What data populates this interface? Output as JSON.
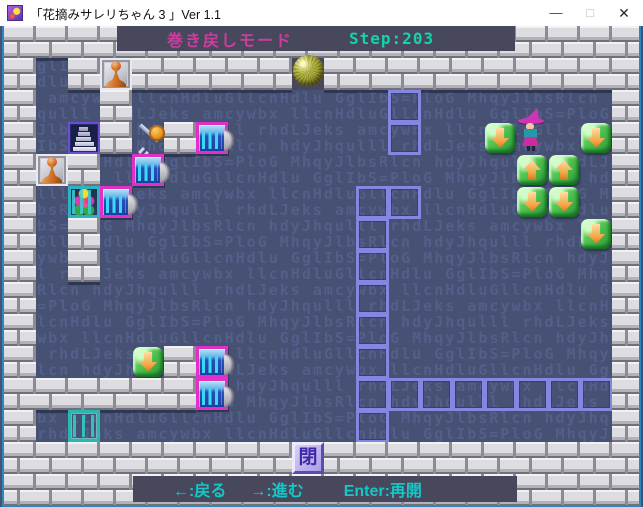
{
  "window": {
    "title": "「花摘みサレリちゃん 3 」Ver 1.1",
    "minimize_label": "—",
    "maximize_label": "□",
    "close_label": "✕"
  },
  "hud": {
    "mode": "巻き戻しモード",
    "step": "Step:203"
  },
  "controls": {
    "back": "←:戻る",
    "forward": "→:進む",
    "resume": "Enter:再開"
  },
  "board": {
    "tile_size": 32,
    "cols": 20,
    "rows": 15,
    "close_label": "閉",
    "legend": {
      "#": "brick-wall",
      ".": "empty-floor",
      "P": "pawn-block",
      "S": "stairs",
      "K": "key",
      "G": "closed-gate",
      "O": "open-gate",
      "F": "flower-cage",
      "D": "arrow-tile-down",
      "U": "arrow-tile-up",
      "B": "ball",
      "W": "witch-player",
      "T": "trail-marker",
      "C": "close-tile"
    },
    "map": [
      "####################",
      "#.#P#####B##########",
      "#..#........T......#",
      "#.S#K#G.....T..DW.D#",
      "#P#.G...........UU.#",
      "#.FG.......TT...DD.#",
      "#.#........T......D#",
      "#.#........T.......#",
      "#..........T.......#",
      "#..........T.......#",
      "#...D#G....T.......#",
      "######G....TTTTTTTT#",
      "#.O........T.......#",
      "#########C##########",
      "####################"
    ]
  },
  "watermark": {
    "text": "hdyJhqulll rhdLJeks amcywbx llcnHdluGllcnHdlu GglIbS=PloG MhqyJlbsRlcn "
  },
  "colors": {
    "field_bg": "#465174",
    "brick": "#dcdce1",
    "mortar": "#8b8b95",
    "hud_bg": "#47485c",
    "mode_text": "#cf3ba0",
    "step_text": "#17d1ae",
    "controls_text": "#14c8c8",
    "trail": "#8487e2",
    "gate_frame": "#e030c8",
    "gate_bars": "#40d8f0",
    "open_gate": "#28b8b0",
    "arrow_tile_green": "#52c452",
    "arrow_glyph_orange": "#f0a040",
    "pawn_orange": "#d2691e",
    "ball_yellow_green": "#a8a830",
    "close_tile_lavender": "#a89ee4",
    "window_border_teal": "#2f86b8"
  }
}
